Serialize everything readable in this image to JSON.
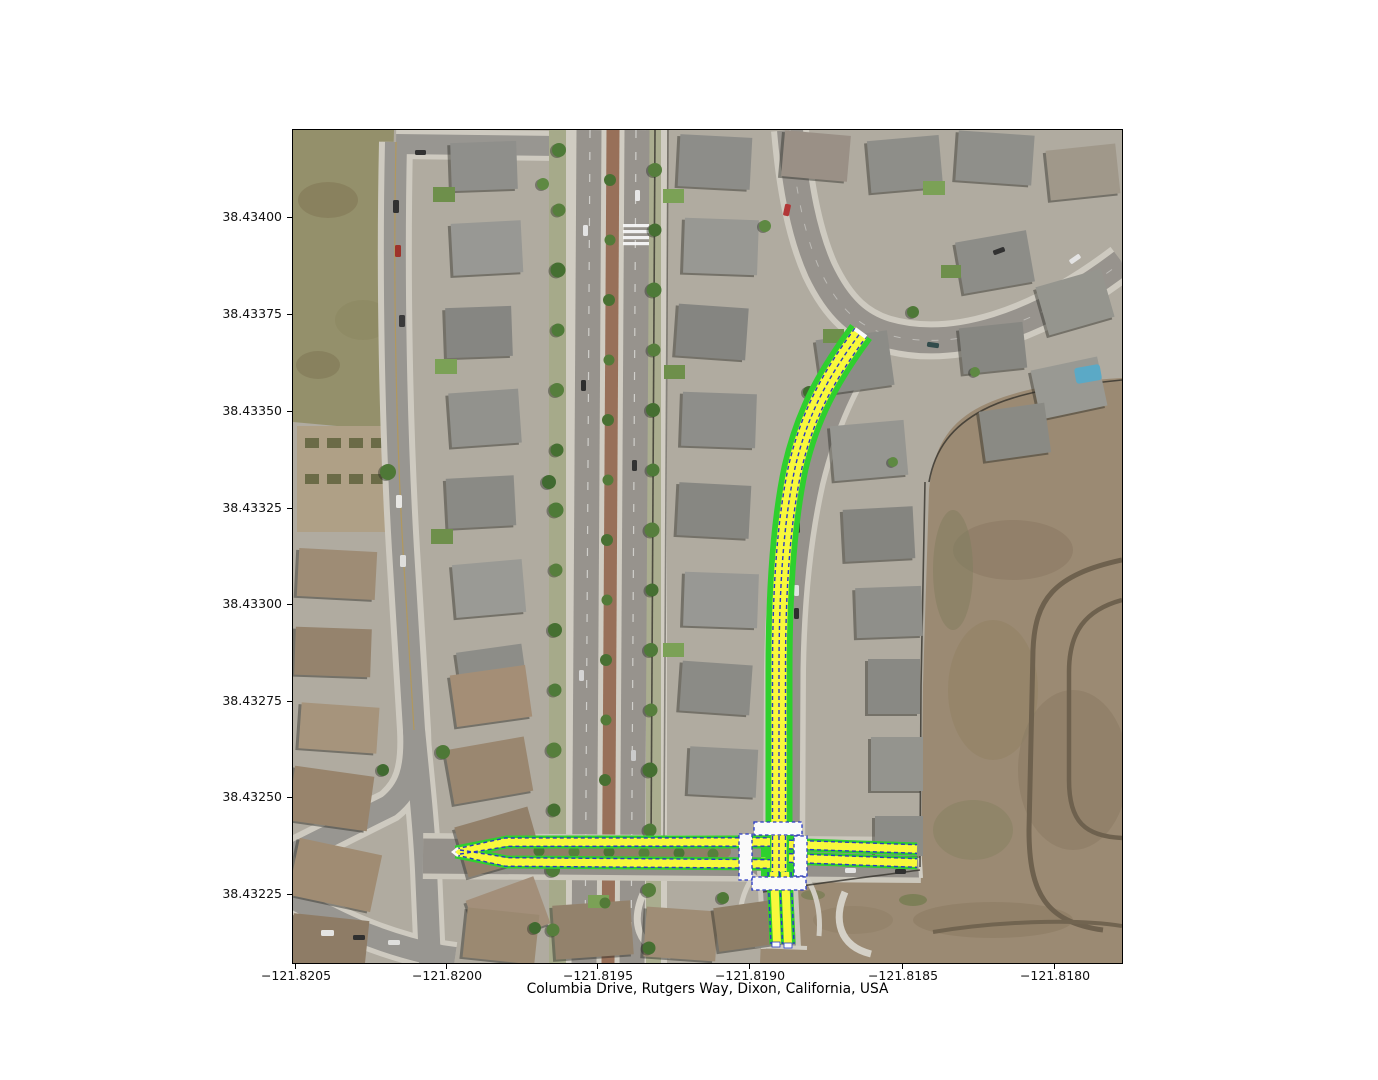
{
  "figure": {
    "title": "Columbia Drive, Rutgers Way, Dixon, California, USA"
  },
  "axes": {
    "x_ticks": [
      "−121.8205",
      "−121.8200",
      "−121.8195",
      "−121.8190",
      "−121.8185",
      "−121.8180"
    ],
    "y_ticks": [
      "38.43400",
      "38.43375",
      "38.43350",
      "38.43325",
      "38.43300",
      "38.43275",
      "38.43250",
      "38.43225"
    ]
  },
  "map_overlay": {
    "route_casing_color": "#2bd42b",
    "lane_fill_color": "#fdfd3a",
    "lane_boundary_color": "#2436c8",
    "crosswalk_color": "#ffffff"
  }
}
